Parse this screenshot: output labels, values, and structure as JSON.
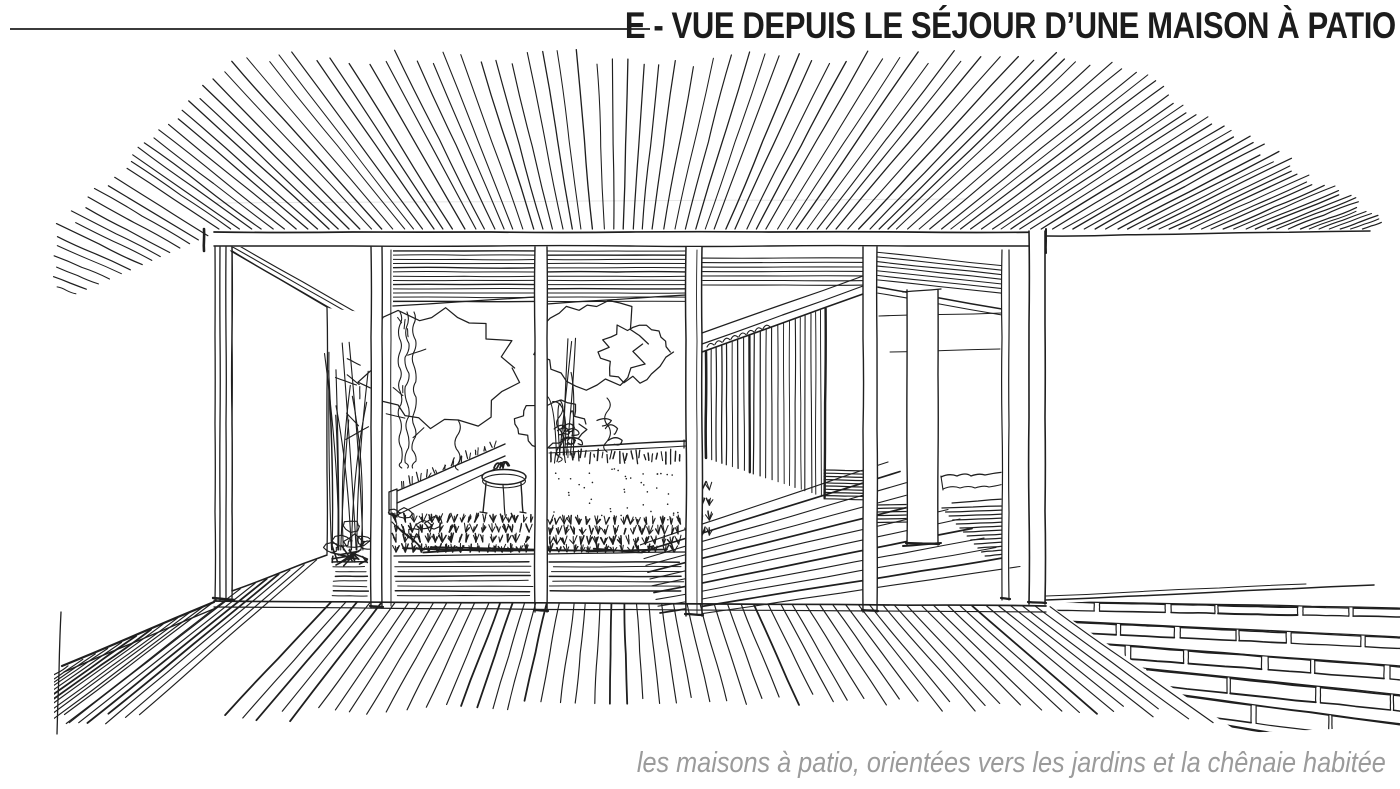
{
  "page": {
    "background_color": "#ffffff"
  },
  "header": {
    "title": "E - VUE DEPUIS LE SÉJOUR D’UNE MAISON À PATIO",
    "title_color": "#1c1c1c",
    "rule_color": "#3b3b3b"
  },
  "sketch": {
    "type": "hand-drawn perspective ink sketch",
    "ink_color": "#1f1f1f",
    "elements": [
      "roof-ray-hatching",
      "header-beam",
      "glazed-facade-mullions",
      "side-wall",
      "reed-plants",
      "rocks",
      "shrub-outlines",
      "planter-edge",
      "round-side-table",
      "grass-field",
      "slatted-screen",
      "pergola-beams",
      "interior-column",
      "daybed",
      "wood-deck-boards",
      "interior-floorboards",
      "brick-paving"
    ]
  },
  "caption": {
    "text": "les maisons à patio, orientées vers les jardins et la chênaie habitée",
    "color": "#9b9b9b"
  }
}
